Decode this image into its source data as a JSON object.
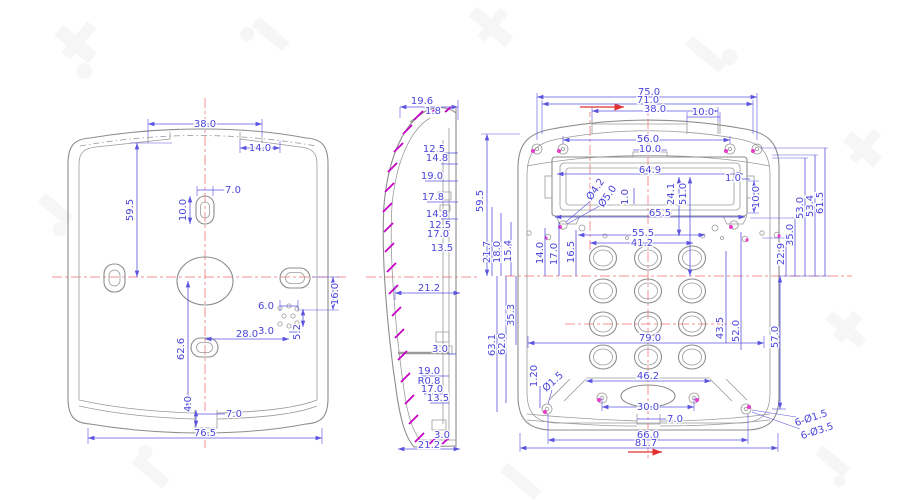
{
  "colors": {
    "dimension_blue": "#4a44da",
    "outline_gray": "#8d8d8d",
    "centerline_red": "#f49090",
    "arrow_red": "#e03030",
    "hatch_magenta": "#c400c4",
    "screw_pink": "#e83ccb"
  },
  "back": {
    "dims": {
      "top_width": "38.0",
      "top_tab": "14.0",
      "height_upper": "59.5",
      "slot_w": "7.0",
      "slot_h": "10.0",
      "grid_w": "6.0",
      "grid_col": "3.0",
      "grid_right": "16.0",
      "grid_h": "5.2",
      "center_x": "28.0",
      "height_lower": "62.6",
      "notch_h": "4.0",
      "notch_w": "7.0",
      "total_w": "76.5"
    }
  },
  "side": {
    "dims": {
      "depth": "19.6",
      "lip": "1.8",
      "s1": "12.5",
      "s2": "14.8",
      "s3": "19.0",
      "s4": "17.8",
      "s5": "14.8",
      "s6": "12.5",
      "s7": "17.0",
      "s8": "13.5",
      "mid_w": "21.2",
      "tab": "3.0",
      "b1": "19.0",
      "b2": "R0.8",
      "b3": "17.0",
      "b4": "13.5",
      "bot_tab": "3.0",
      "bot_w": "21.2"
    }
  },
  "front": {
    "dims": {
      "w1": "75.0",
      "w2": "71.0",
      "w3": "38.0",
      "w4": "10.0",
      "w5": "56.0",
      "w6": "10.0",
      "lcd": "64.9",
      "e1": "1.0",
      "r1": "10.0",
      "h1": "Ø4.2",
      "h2": "Ø5.0",
      "g1": "1.0",
      "v1": "24.1",
      "v2": "51.0",
      "w7": "65.5",
      "w8": "55.5",
      "w9": "41.2",
      "hl": "59.5",
      "c1": "21.7",
      "c2": "18.0",
      "c3": "15.4",
      "c4": "14.0",
      "c5": "17.0",
      "c6": "16.5",
      "rr1": "22.9",
      "rr2": "35.0",
      "rr3": "53.0",
      "rr4": "53.4",
      "rr5": "61.5",
      "ll1": "63.1",
      "ll2": "62.0",
      "ll3": "35.3",
      "ll4": "1.20",
      "ll5": "Ø1.5",
      "k1": "79.0",
      "k2": "43.5",
      "k3": "52.0",
      "rr6": "57.0",
      "sp1": "46.2",
      "sp2": "30.0",
      "bn": "7.0",
      "bw1": "66.0",
      "bw2": "81.7",
      "n1": "6-Ø1.5",
      "n2": "6-Ø3.5"
    }
  }
}
